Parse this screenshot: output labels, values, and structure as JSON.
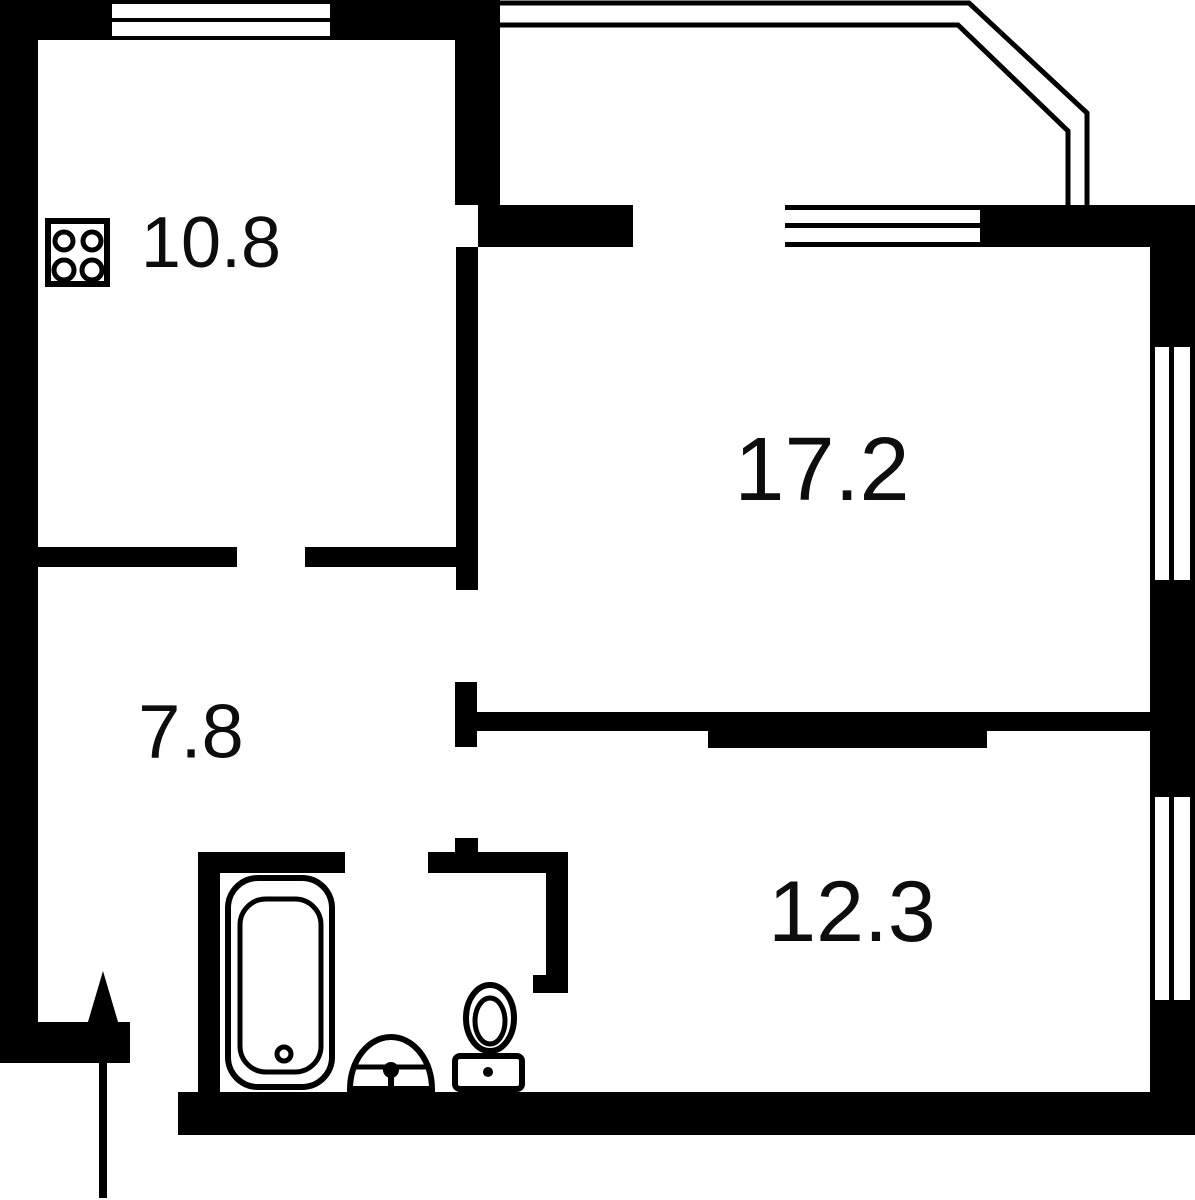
{
  "page": {
    "background": "#ffffff"
  },
  "floorplan": {
    "wall_color": "#000000",
    "label_color": "#0d0d0d",
    "rooms": [
      {
        "name": "kitchen",
        "area_label": "10.8"
      },
      {
        "name": "living-room",
        "area_label": "17.2"
      },
      {
        "name": "hallway",
        "area_label": "7.8"
      },
      {
        "name": "bedroom",
        "area_label": "12.3"
      }
    ],
    "icons": [
      "stove-icon",
      "bathtub-icon",
      "sink-icon",
      "toilet-icon",
      "entrance-arrow-icon",
      "window-icon",
      "balcony-railing-icon"
    ]
  }
}
